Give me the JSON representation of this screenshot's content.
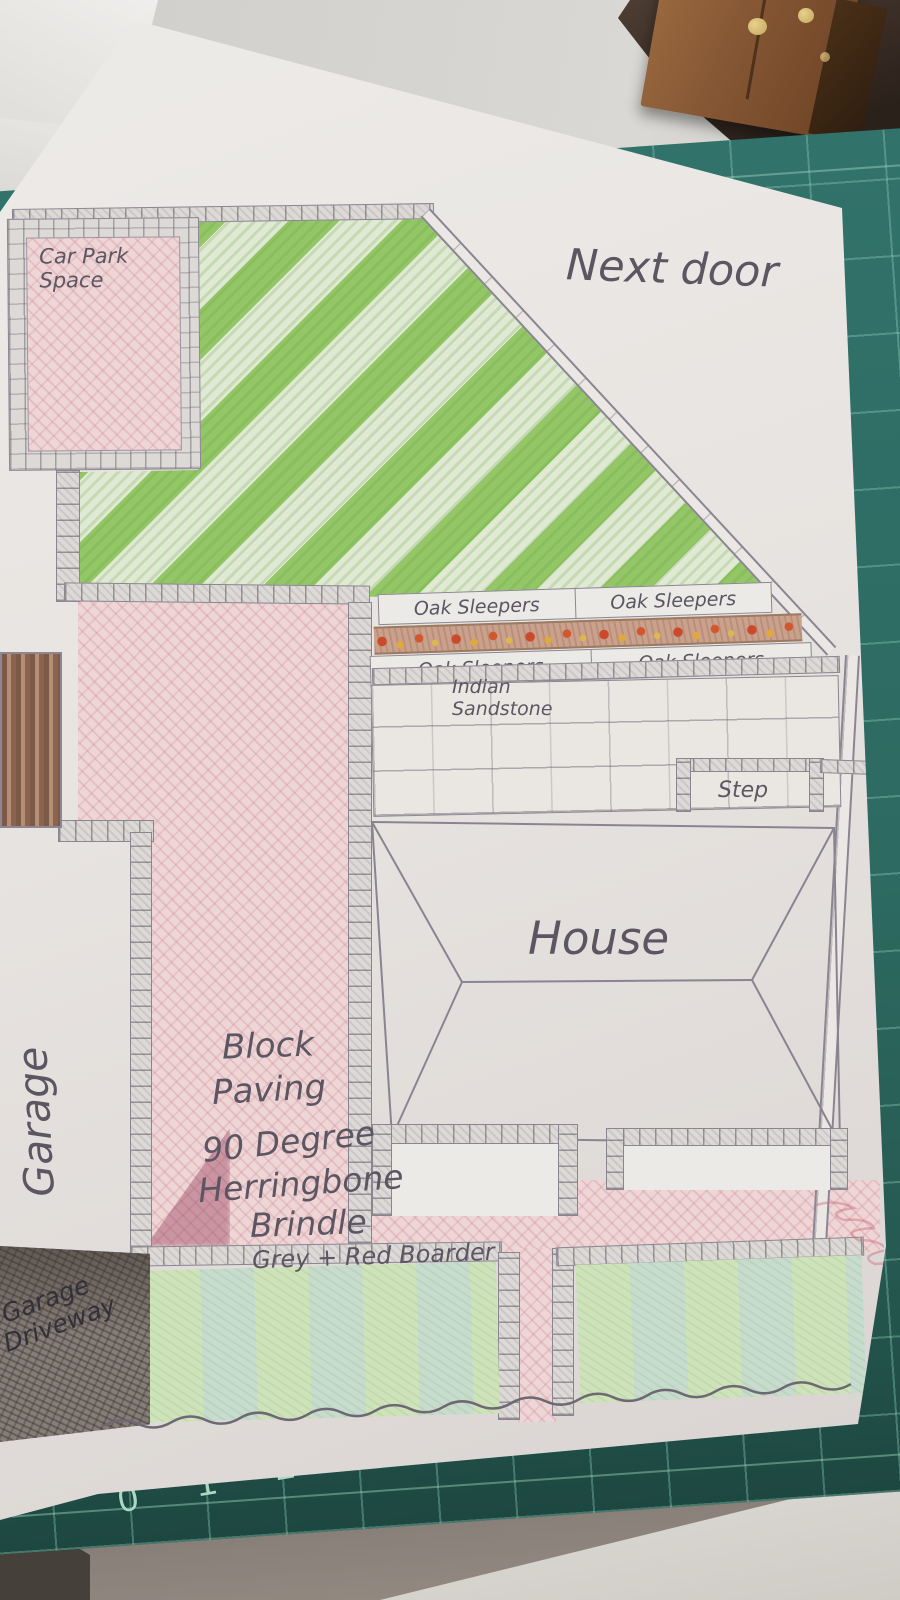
{
  "plan": {
    "next_door_label": "Next door",
    "car_park": {
      "line1": "Car Park",
      "line2": "Space"
    },
    "oak_sleepers_labels": [
      "Oak Sleepers",
      "Oak Sleepers",
      "Oak Sleepers",
      "Oak Sleepers"
    ],
    "indian_sandstone": {
      "line1": "Indian",
      "line2": "Sandstone"
    },
    "step_label": "Step",
    "house_label": "House",
    "paving_note": {
      "line1": "Block",
      "line2": "Paving",
      "line3": "90 Degree",
      "line4": "Herringbone",
      "line5": "Brindle",
      "line6": "Grey + Red Boarder"
    },
    "garage_label": "Garage",
    "garage_driveway": {
      "line1": "Garage",
      "line2": "Driveway"
    }
  },
  "cutting_mat": {
    "ruler_numbers": [
      "0",
      "1",
      "2",
      "3",
      "4",
      "5",
      "6"
    ],
    "right_edge_number": "19",
    "mat_color": "#2e6c63",
    "grid_color": "#9ed9c2"
  },
  "colors": {
    "paper": "#e8e4e1",
    "pencil": "#6b6570",
    "paving_pink": "#eed6d6",
    "lawn_green": "#8fc25e",
    "lawn_pale": "#dce6d0",
    "sleeper_soil": "#c9a18c",
    "gate_brown": "#8a6450",
    "driveway_grey": "#8f8882",
    "wood_box": "#855633"
  }
}
